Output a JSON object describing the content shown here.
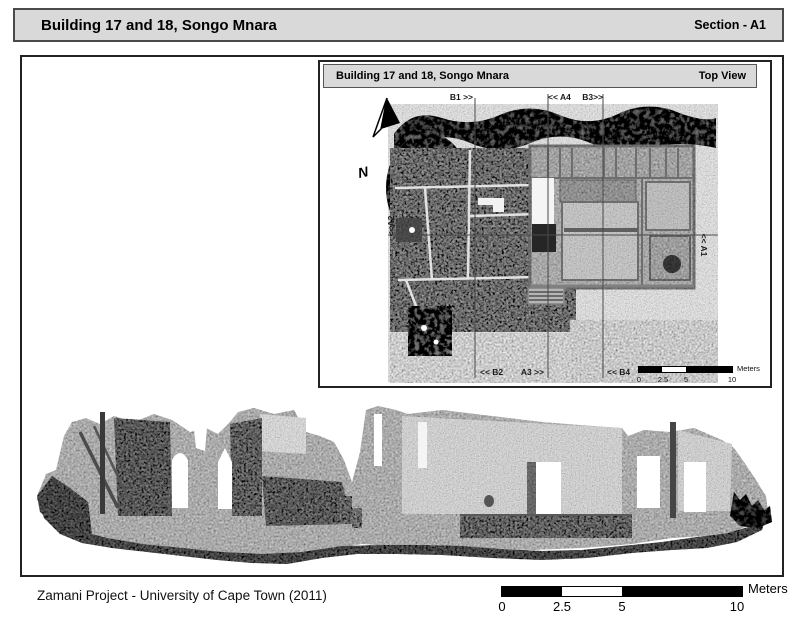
{
  "header": {
    "title": "Building 17 and 18, Songo Mnara",
    "section_label": "Section - A1"
  },
  "inset": {
    "title": "Building 17 and 18, Songo Mnara",
    "view_label": "Top View",
    "north_label": "N",
    "markers": {
      "top": [
        "B1 >>",
        "<< A4",
        "B3>>"
      ],
      "bottom": [
        "<< B2",
        "A3 >>",
        "<< B4"
      ],
      "left": "<<A2",
      "right": "<< A1"
    },
    "scale_bar": {
      "unit": "Meters",
      "ticks": [
        "0",
        "2.5",
        "5",
        "10"
      ]
    }
  },
  "main_scale_bar": {
    "unit": "Meters",
    "ticks": [
      "0",
      "2.5",
      "5",
      "10"
    ]
  },
  "footer": {
    "credit": "Zamani Project - University of Cape Town (2011)"
  },
  "colors": {
    "panel_gray": "#d9d9d9",
    "frame_dark": "#222222",
    "scalebar_black": "#000000",
    "section_line_gray": "#4a4a4a"
  }
}
